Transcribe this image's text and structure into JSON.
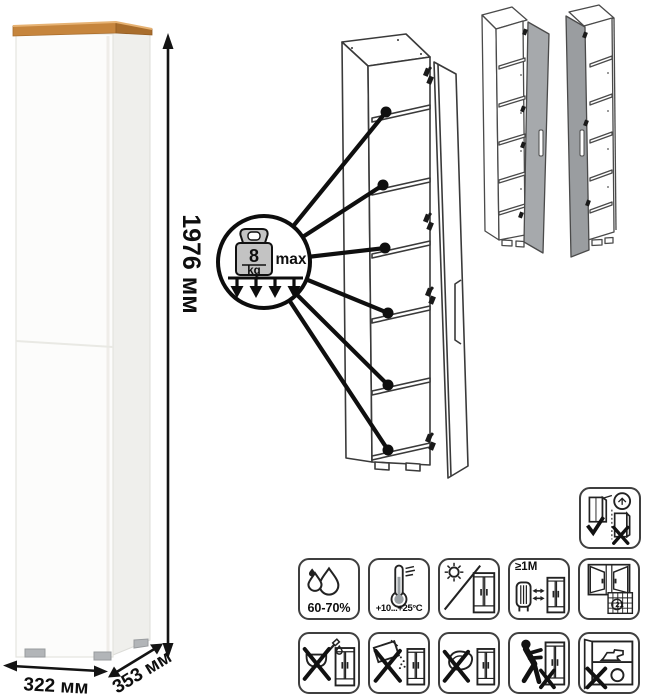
{
  "product": {
    "type": "tall narrow cabinet",
    "dimensions": {
      "height": "1976 мм",
      "width": "322 мм",
      "depth": "353 мм"
    }
  },
  "load_badge": {
    "value": "8",
    "unit": "kg",
    "qualifier": "max",
    "shelves_pointed": 6
  },
  "colors": {
    "wood_top": "#c6853d",
    "body_white": "#fcfcfb",
    "door_gray": "#a6a9ac",
    "line": "#3a3a3a"
  },
  "icon_grid": {
    "row1": [
      {
        "name": "humidity-icon",
        "label": "60-70%"
      },
      {
        "name": "temperature-range-icon",
        "label": "+10...+25°C"
      },
      {
        "name": "no-direct-sunlight-icon",
        "label": ""
      },
      {
        "name": "heat-distance-icon",
        "label": "≥1M"
      },
      {
        "name": "ventilation-calendar-icon",
        "label": "21"
      }
    ],
    "row2": [
      {
        "name": "no-liquids-icon",
        "label": ""
      },
      {
        "name": "no-abrasive-powder-icon",
        "label": ""
      },
      {
        "name": "no-wet-sponge-icon",
        "label": ""
      },
      {
        "name": "do-not-drag-icon",
        "label": ""
      },
      {
        "name": "no-heavy-items-icon",
        "label": ""
      }
    ]
  },
  "wall_mount_icon": {
    "name": "secure-to-wall-icon"
  }
}
